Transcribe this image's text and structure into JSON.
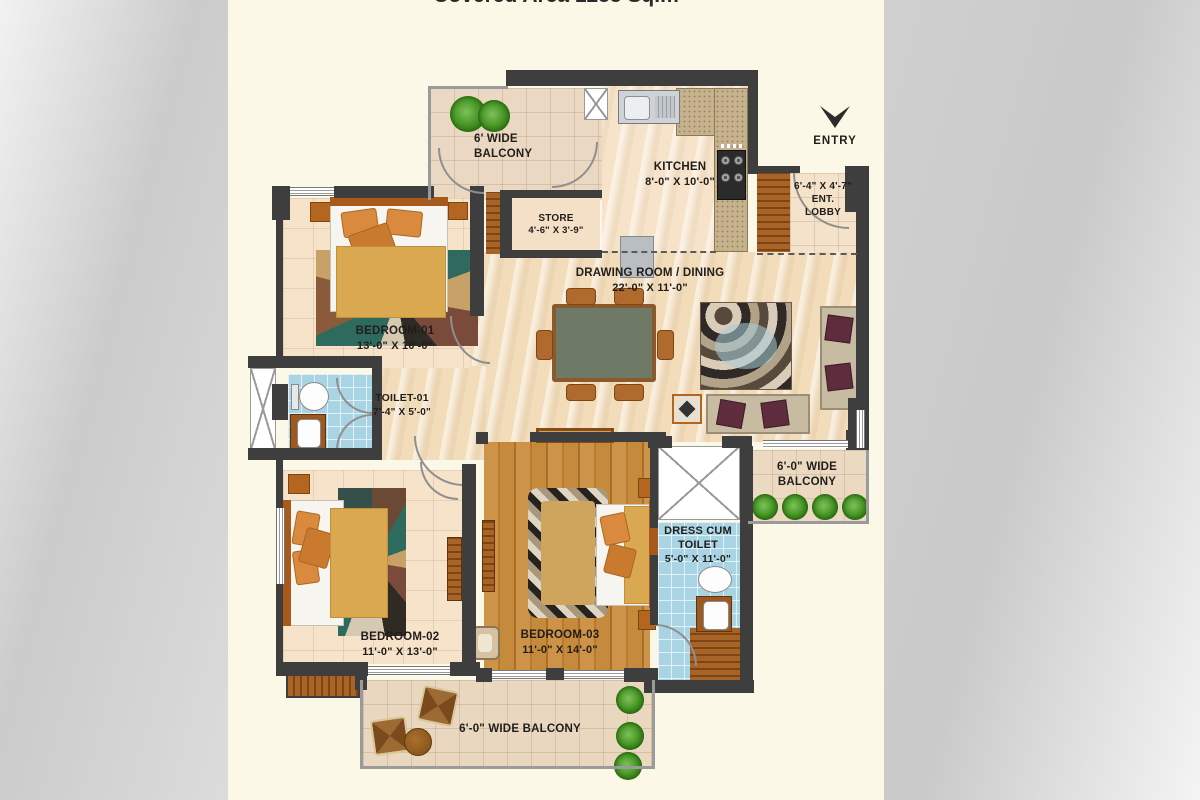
{
  "page": {
    "title_clipped": "Covered Area 1255 Sq.m"
  },
  "plan": {
    "entry": {
      "label": "ENTRY"
    },
    "rooms": {
      "balcony_top": {
        "name_line1": "6' WIDE",
        "name_line2": "BALCONY"
      },
      "kitchen": {
        "name": "KITCHEN",
        "dims": "8'-0\" X 10'-0\""
      },
      "store": {
        "name": "STORE",
        "dims": "4'-6\" X 3'-9\""
      },
      "ent_lobby": {
        "dims": "6'-4\" X 4'-7\"",
        "name_line1": "ENT.",
        "name_line2": "LOBBY"
      },
      "drawing_dining": {
        "name": "DRAWING ROOM / DINING",
        "dims": "22'-0\" X 11'-0\""
      },
      "bedroom_01": {
        "name": "BEDROOM-01",
        "dims": "13'-0\" X 10'-0\""
      },
      "toilet_01": {
        "name": "TOILET-01",
        "dims": "7'-4\" X 5'-0\""
      },
      "balcony_right": {
        "name_line1": "6'-0\" WIDE",
        "name_line2": "BALCONY"
      },
      "dress_toilet": {
        "name_line1": "DRESS CUM",
        "name_line2": "TOILET",
        "dims": "5'-0\" X 11'-0\""
      },
      "bedroom_02": {
        "name": "BEDROOM-02",
        "dims": "11'-0\" X 13'-0\""
      },
      "bedroom_03": {
        "name": "BEDROOM-03",
        "dims": "11'-0\" X 14'-0\""
      },
      "balcony_bottom": {
        "name": "6'-0\" WIDE BALCONY"
      }
    },
    "colors": {
      "wall": "#3e3e3e",
      "cream_bg": "#fcf8e7",
      "blue_floor": "#a9d4e4",
      "wood_floor": "#c68a3d",
      "tile_floor": "#f6e3c9",
      "accent_wood": "#a86327",
      "plant_green": "#3f8d1e"
    }
  }
}
